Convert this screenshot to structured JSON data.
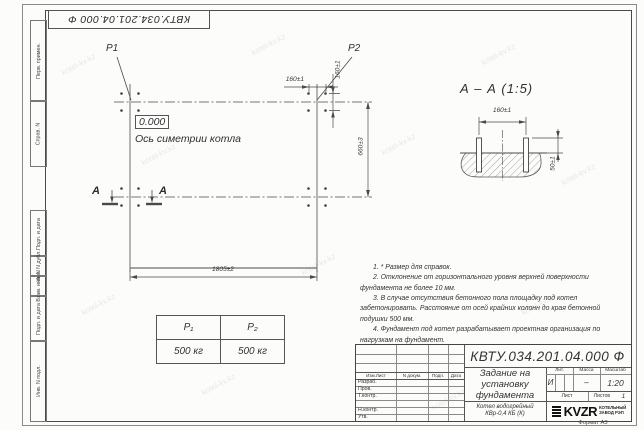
{
  "watermark": "kotel-kv.kz",
  "doc_number": "КВТУ.034.201.04.000 Ф",
  "margin_labels": [
    "Перв. примен.",
    "Справ. N",
    "Подп. и дата",
    "Инв. N дубл.",
    "Взам. инв. N",
    "Подп. и дата",
    "Инв. N подл."
  ],
  "plan": {
    "p1_label": "P1",
    "p2_label": "P2",
    "elevation": "0.000",
    "axis_label": "Ось симетрии котла",
    "section_letter_left": "А",
    "section_letter_right": "А",
    "dim_bolt_spacing_h": "160±1",
    "dim_bolt_spacing_v": "160±1",
    "dim_height": "660±3",
    "dim_width": "1805±2"
  },
  "section": {
    "title": "А – А (1:5)",
    "dim_bolt_spacing": "160±1",
    "dim_protrusion": "50±1"
  },
  "notes": [
    "1. * Размер для справок.",
    "2. Отклонение от горизонтального уровня верхней поверхности фундамента не более 10 мм.",
    "3. В случае отсутствия бетонного пола площадку под котел забетонировать. Расстояние от осей крайних колонн до края бетонной подушки 500 мм.",
    "4. Фундамент под котел разрабатывает проектная организация по нагрузкам на фундамент."
  ],
  "load_table": {
    "headers": [
      "P₁",
      "P₂"
    ],
    "values": [
      "500 кг",
      "500 кг"
    ]
  },
  "title_block": {
    "designation": "КВТУ.034.201.04.000 Ф",
    "title_lines": [
      "Задание на",
      "установку",
      "фундамента"
    ],
    "product_lines": [
      "Котел водогрейный",
      "КВр-0,4 КБ (К)"
    ],
    "rev_headers": [
      "Изм.Лист",
      "N докум.",
      "Подп.",
      "Дата"
    ],
    "row_labels": [
      "Разраб.",
      "Пров.",
      "Т.контр.",
      "",
      "Н.контр.",
      "Утв."
    ],
    "lit_label": "Лит.",
    "lit_value": "И",
    "mass_label": "Масса",
    "mass_value": "–",
    "scale_label": "Масштаб",
    "scale_value": "1:20",
    "sheet_label": "Лист",
    "sheets_label": "Листов",
    "sheets_value": "1",
    "logo_text": "KVZR",
    "logo_caption": [
      "КОТЕЛЬНЫЙ",
      "ЗАВОД РЭП"
    ],
    "format_label": "Формат А3"
  }
}
